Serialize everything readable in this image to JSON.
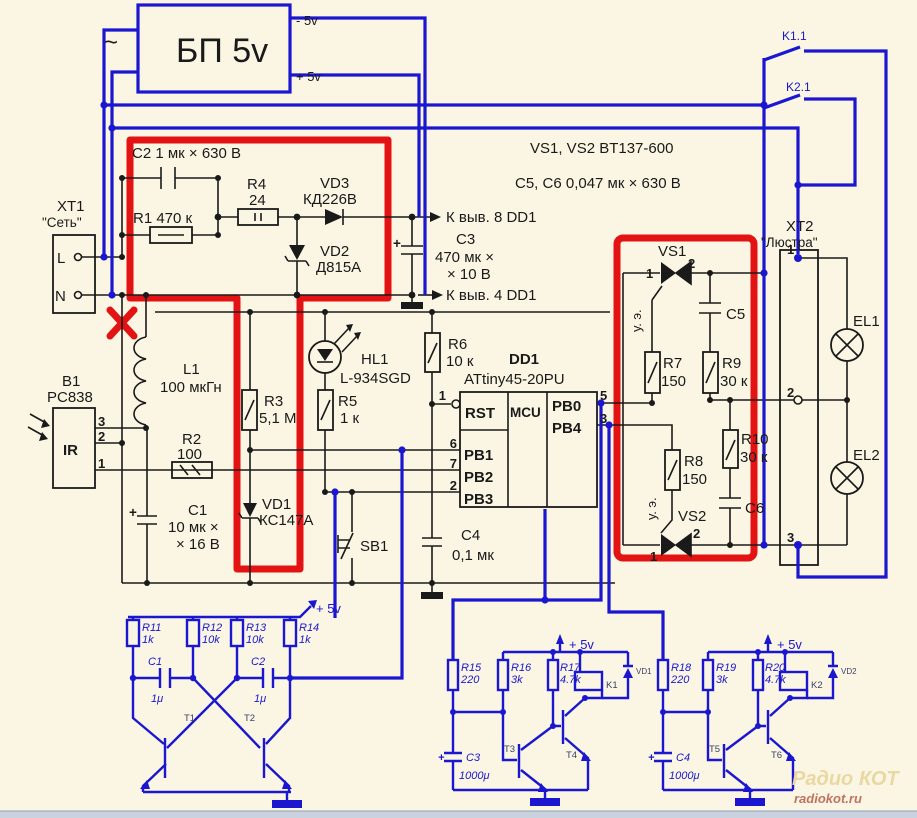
{
  "colors": {
    "background": "#faf6e3",
    "wire_black": "#1a1a1a",
    "wire_blue": "#1b16d0",
    "highlight_red": "#e31313",
    "watermark_tan": "#e9d8a2",
    "watermark_red": "#bf7460"
  },
  "psu": {
    "label": "БП 5v",
    "ac": "~",
    "out_minus": "- 5v",
    "out_plus": "+ 5v"
  },
  "relays_top": {
    "k11": "K1.1",
    "k21": "K2.1"
  },
  "notes": {
    "triacs": "VS1, VS2 BT137-600",
    "caps": "C5, C6 0,047 мк × 630 В"
  },
  "mains": {
    "conn": "XT1",
    "title": "\"Сеть\"",
    "l": "L",
    "n": "N"
  },
  "hv": {
    "c2": "C2 1 мк × 630 В",
    "r1": "R1 470 к",
    "r4": "R4",
    "r4_val": "24",
    "vd3": "VD3",
    "vd3_type": "КД226В",
    "vd2": "VD2",
    "vd2_type": "Д815А",
    "to_pin8": "К выв. 8 DD1",
    "to_pin4": "К выв. 4 DD1",
    "c3": "C3",
    "c3_val1": "470 мк ×",
    "c3_val2": "× 10 В",
    "c3_plus": "+"
  },
  "lv": {
    "l1": "L1",
    "l1_val": "100 мкГн",
    "b1": "B1",
    "b1_type": "PC838",
    "ir": "IR",
    "pin3": "3",
    "pin2": "2",
    "pin1": "1",
    "r2": "R2",
    "r2_val": "100",
    "r3": "R3",
    "r3_val": "5,1 М",
    "r5": "R5",
    "r5_val": "1 к",
    "hl1": "HL1",
    "hl1_type": "L-934SGD",
    "r6": "R6",
    "r6_val": "10 к",
    "vd1": "VD1",
    "vd1_type": "КС147А",
    "c1": "C1",
    "c1_val1": "10 мк ×",
    "c1_val2": "× 16 В",
    "c1_plus": "+",
    "sb1": "SB1",
    "c4": "C4",
    "c4_val": "0,1 мк"
  },
  "mcu": {
    "ref": "DD1",
    "part": "ATtiny45-20PU",
    "rst": "RST",
    "core": "MCU",
    "pb0": "PB0",
    "pb4": "PB4",
    "pb1": "PB1",
    "pb2": "PB2",
    "pb3": "PB3",
    "pin1": "1",
    "pin5": "5",
    "pin3": "3",
    "pin6": "6",
    "pin7": "7",
    "pin2": "2"
  },
  "triac": {
    "vs1": "VS1",
    "vs2": "VS2",
    "gate1": "у. э.",
    "gate2": "у. э.",
    "vs1_p1": "1",
    "vs1_p2": "2",
    "vs2_p1": "1",
    "vs2_p2": "2",
    "r7": "R7",
    "r7_val": "150",
    "r8": "R8",
    "r8_val": "150",
    "r9": "R9",
    "r9_val": "30 к",
    "r10": "R10",
    "r10_val": "30 к",
    "c5": "C5",
    "c6": "C6"
  },
  "load": {
    "conn": "XT2",
    "title": "\"Люстра\"",
    "t1": "1",
    "t2": "2",
    "t3": "3",
    "el1": "EL1",
    "el2": "EL2"
  },
  "mv": {
    "plus": "+ 5v",
    "r11": "R11",
    "r11_val": "1k",
    "r12": "R12",
    "r12_val": "10k",
    "r13": "R13",
    "r13_val": "10k",
    "r14": "R14",
    "r14_val": "1k",
    "c1": "C1",
    "c1_val": "1μ",
    "c2": "C2",
    "c2_val": "1μ",
    "t1": "T1",
    "t2": "T2"
  },
  "drv1": {
    "plus": "+ 5v",
    "r15": "R15",
    "r15_val": "220",
    "r16": "R16",
    "r16_val": "3k",
    "r17": "R17",
    "r17_val": "4.7k",
    "k1": "K1",
    "vd1": "VD1",
    "t3": "T3",
    "t4": "T4",
    "c3": "C3",
    "c3_val": "1000μ",
    "c3_plus": "+"
  },
  "drv2": {
    "plus": "+ 5v",
    "r18": "R18",
    "r18_val": "220",
    "r19": "R19",
    "r19_val": "3k",
    "r20": "R20",
    "r20_val": "4.7k",
    "k2": "K2",
    "vd2": "VD2",
    "t5": "T5",
    "t6": "T6",
    "c4": "C4",
    "c4_val": "1000μ",
    "c4_plus": "+"
  },
  "watermark": {
    "line1": "Радио КОТ",
    "line2": "radiokot.ru"
  }
}
